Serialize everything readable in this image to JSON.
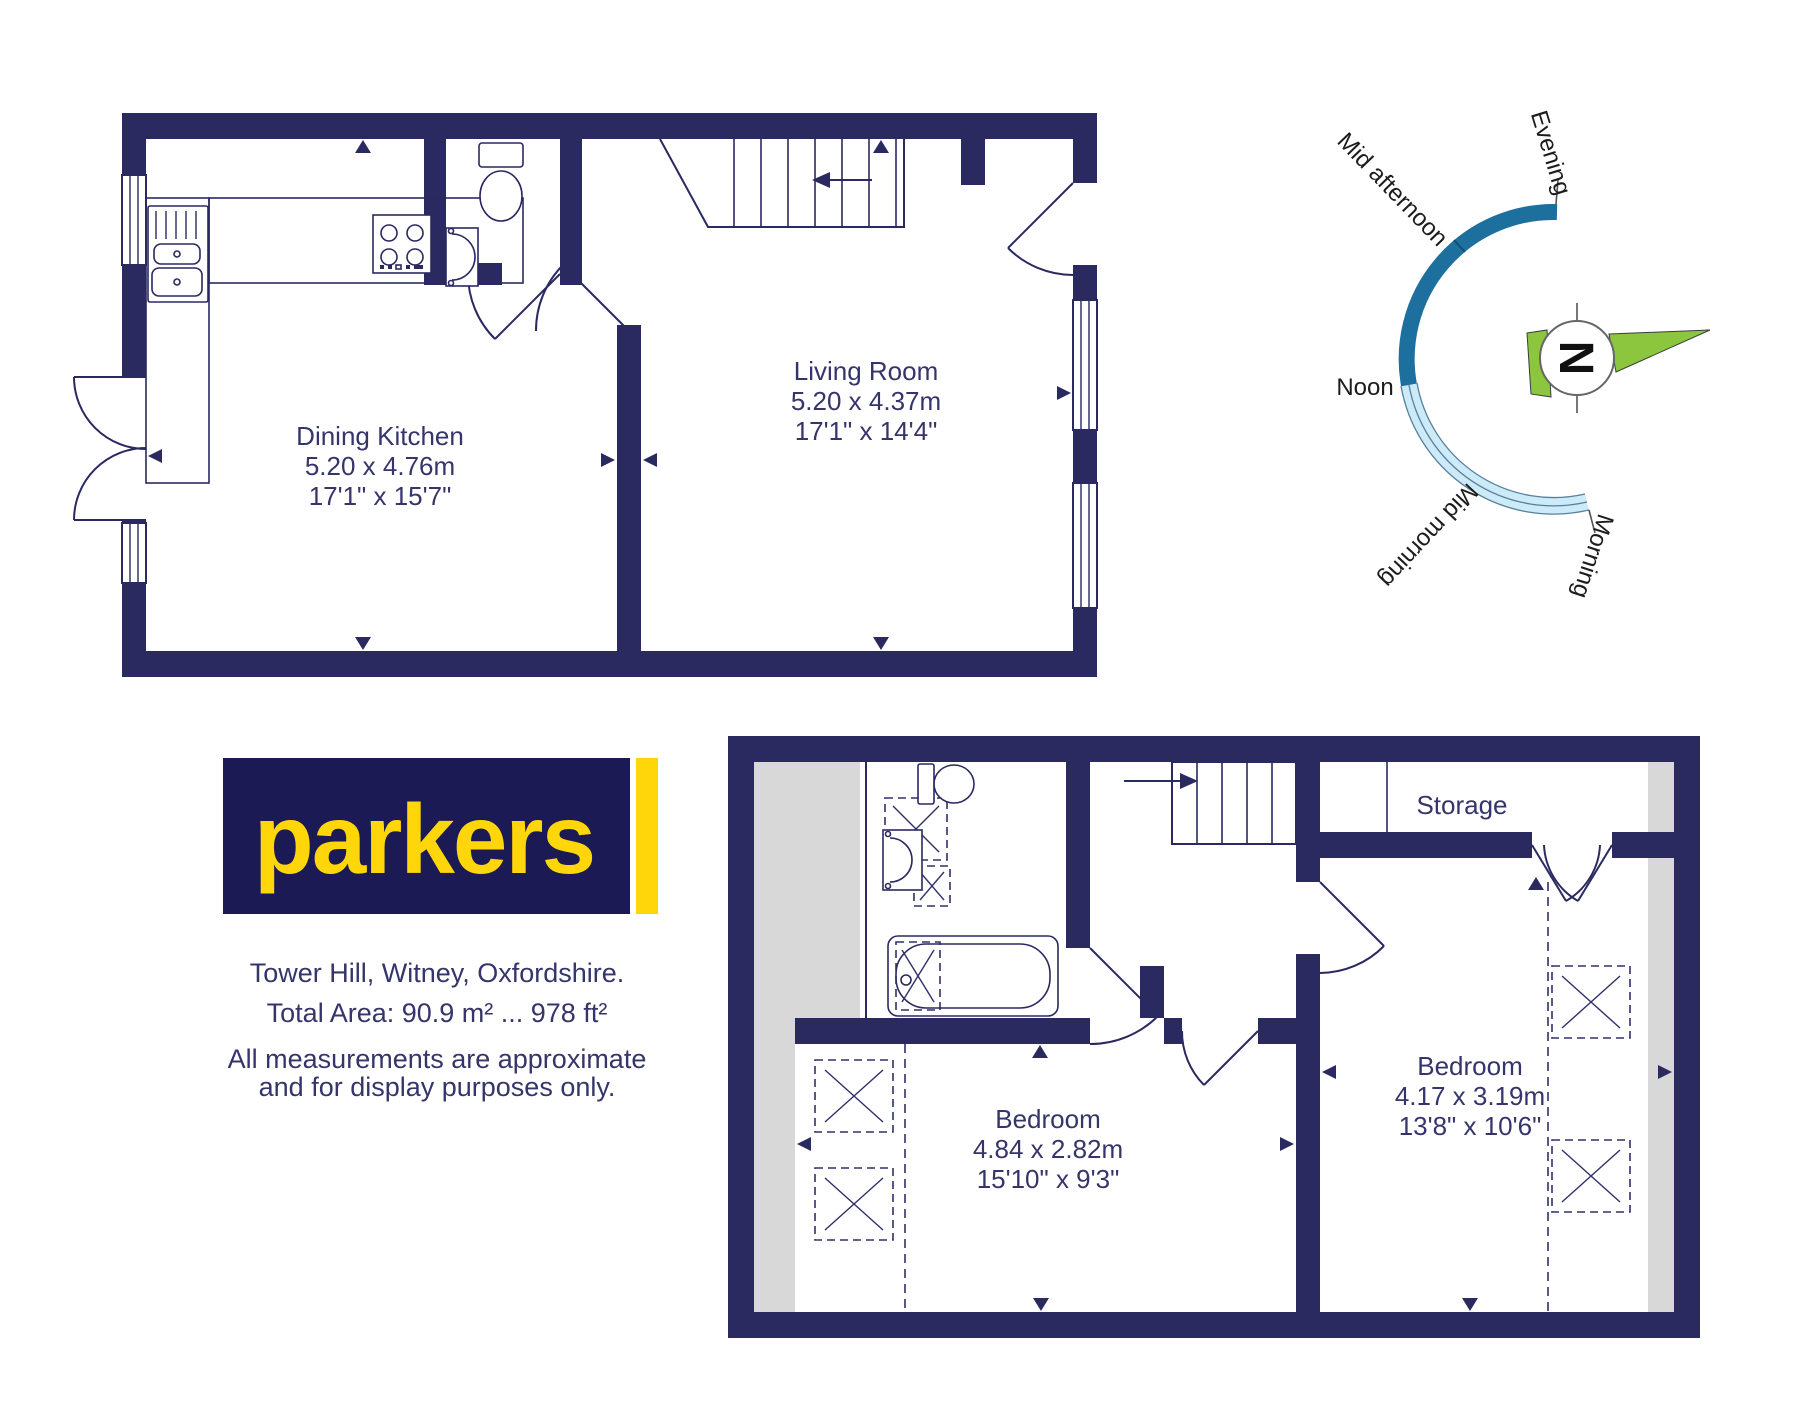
{
  "branding": {
    "logo": "parkers",
    "address": "Tower Hill, Witney, Oxfordshire.",
    "total_area": "Total Area: 90.9 m² ... 978 ft²",
    "disclaimer1": "All measurements are approximate",
    "disclaimer2": "and for display purposes only."
  },
  "ground_floor": {
    "dining_kitchen": {
      "name": "Dining Kitchen",
      "metric": "5.20 x 4.76m",
      "imperial": "17'1\" x 15'7\""
    },
    "living_room": {
      "name": "Living Room",
      "metric": "5.20 x 4.37m",
      "imperial": "17'1\" x 14'4\""
    }
  },
  "first_floor": {
    "bedroom_left": {
      "name": "Bedroom",
      "metric": "4.84 x 2.82m",
      "imperial": "15'10\" x 9'3\""
    },
    "bedroom_right": {
      "name": "Bedroom",
      "metric": "4.17 x 3.19m",
      "imperial": "13'8\" x 10'6\""
    },
    "storage": {
      "name": "Storage"
    }
  },
  "compass": {
    "north": "N",
    "evening": "Evening",
    "mid_afternoon": "Mid afternoon",
    "noon": "Noon",
    "mid_morning": "Mid morning",
    "morning": "Morning"
  },
  "colors": {
    "wall_navy": "#2a2960",
    "label_navy": "#35356b",
    "gray_slope": "#d8d8d8",
    "arc_dark_blue": "#1d6f9e",
    "arc_light_blue": "#cdeaf8",
    "compass_green": "#8cc63f",
    "logo_navy": "#1c1a55",
    "logo_yellow": "#ffd60a"
  }
}
